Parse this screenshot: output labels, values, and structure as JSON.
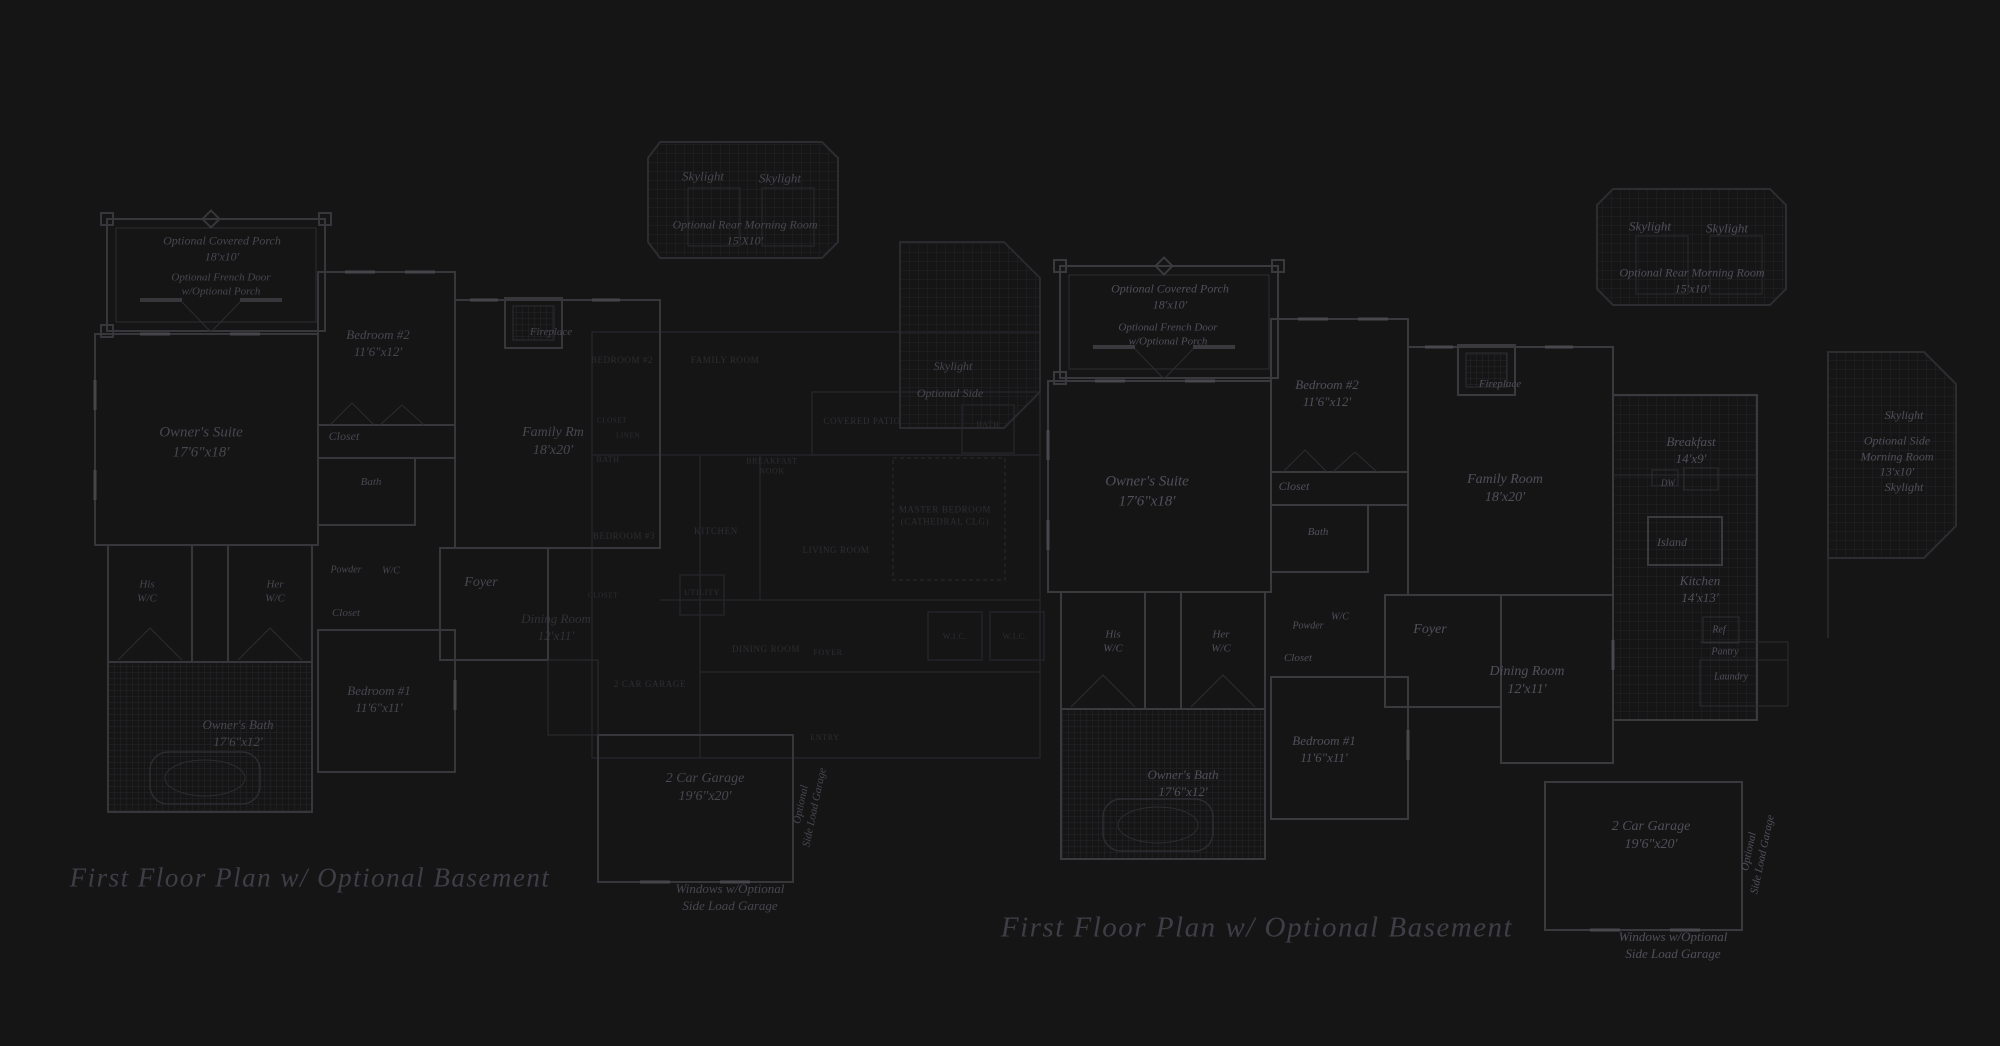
{
  "page": {
    "background": "#151516",
    "wall_color_bright": "#3a3a3e",
    "wall_color_mid": "#2d2d31",
    "wall_color_faint": "#242428",
    "grid_color": "#222226",
    "label_color": "#4b4b52",
    "caption_color": "#3e3e46"
  },
  "captions": {
    "left": "First Floor Plan  w/ Optional Basement",
    "right": "First Floor Plan  w/ Optional Basement"
  },
  "plans": {
    "left_plan": {
      "title": "First Floor Plan w/ Optional Basement (left)",
      "labels": [
        {
          "t": "Optional Covered Porch\n18'x10'",
          "x": 222,
          "y": 249,
          "s": 12
        },
        {
          "t": "Optional French Door\nw/Optional Porch",
          "x": 221,
          "y": 285,
          "s": 11
        },
        {
          "t": "Owner's Suite\n17'6\"x18'",
          "x": 201,
          "y": 443,
          "s": 15
        },
        {
          "t": "Bedroom #2\n11'6\"x12'",
          "x": 378,
          "y": 344,
          "s": 13
        },
        {
          "t": "Closet",
          "x": 344,
          "y": 437,
          "s": 12
        },
        {
          "t": "Bath",
          "x": 371,
          "y": 482,
          "s": 11
        },
        {
          "t": "Fireplace",
          "x": 551,
          "y": 332,
          "s": 11
        },
        {
          "t": "Family Rm\n18'x20'",
          "x": 553,
          "y": 442,
          "s": 14
        },
        {
          "t": "His\nW/C",
          "x": 147,
          "y": 592,
          "s": 11
        },
        {
          "t": "Her\nW/C",
          "x": 275,
          "y": 592,
          "s": 11
        },
        {
          "t": "Powder",
          "x": 346,
          "y": 570,
          "s": 10
        },
        {
          "t": "W/C",
          "x": 391,
          "y": 571,
          "s": 10
        },
        {
          "t": "Closet",
          "x": 346,
          "y": 613,
          "s": 11
        },
        {
          "t": "Foyer",
          "x": 481,
          "y": 583,
          "s": 14
        },
        {
          "t": "Dining Room\n12'x11'",
          "x": 556,
          "y": 628,
          "s": 13,
          "o": 0.55
        },
        {
          "t": "Bedroom #1\n11'6\"x11'",
          "x": 379,
          "y": 700,
          "s": 13
        },
        {
          "t": "Owner's Bath\n17'6\"x12'",
          "x": 238,
          "y": 734,
          "s": 13
        },
        {
          "t": "2 Car Garage\n19'6\"x20'",
          "x": 705,
          "y": 788,
          "s": 14
        },
        {
          "t": "Optional\nSide Load Garage",
          "x": 808,
          "y": 806,
          "s": 11,
          "r": -78
        },
        {
          "t": "Windows w/Optional\nSide Load Garage",
          "x": 730,
          "y": 898,
          "s": 13
        },
        {
          "t": "Skylight",
          "x": 703,
          "y": 177,
          "s": 13
        },
        {
          "t": "Skylight",
          "x": 780,
          "y": 179,
          "s": 13
        },
        {
          "t": "Optional Rear Morning Room\n15'X10'",
          "x": 745,
          "y": 233,
          "s": 12
        },
        {
          "t": "Skylight",
          "x": 953,
          "y": 367,
          "s": 12
        },
        {
          "t": "Optional Side",
          "x": 950,
          "y": 394,
          "s": 12
        }
      ]
    },
    "faint_overlay_plan": {
      "title": "underlying alternate plan (very faint)",
      "labels": [
        {
          "t": "BEDROOM #2",
          "x": 622,
          "y": 361,
          "s": 9
        },
        {
          "t": "FAMILY ROOM",
          "x": 725,
          "y": 361,
          "s": 9
        },
        {
          "t": "CLOSET",
          "x": 612,
          "y": 421,
          "s": 7
        },
        {
          "t": "LINEN",
          "x": 628,
          "y": 436,
          "s": 7
        },
        {
          "t": "BATH",
          "x": 608,
          "y": 460,
          "s": 8
        },
        {
          "t": "BREAKFAST\nNOOK",
          "x": 772,
          "y": 467,
          "s": 8
        },
        {
          "t": "BEDROOM #3",
          "x": 624,
          "y": 537,
          "s": 9
        },
        {
          "t": "KITCHEN",
          "x": 716,
          "y": 532,
          "s": 9
        },
        {
          "t": "UTILITY",
          "x": 702,
          "y": 593,
          "s": 8
        },
        {
          "t": "CLOSET",
          "x": 603,
          "y": 596,
          "s": 7
        },
        {
          "t": "DINING ROOM",
          "x": 766,
          "y": 650,
          "s": 9
        },
        {
          "t": "FOYER",
          "x": 828,
          "y": 653,
          "s": 8
        },
        {
          "t": "2 CAR GARAGE",
          "x": 650,
          "y": 685,
          "s": 9
        },
        {
          "t": "ENTRY",
          "x": 825,
          "y": 738,
          "s": 8
        },
        {
          "t": "COVERED PATIO",
          "x": 862,
          "y": 422,
          "s": 9
        },
        {
          "t": "MASTER BEDROOM\n(CATHEDRAL CLG)",
          "x": 945,
          "y": 516,
          "s": 9
        },
        {
          "t": "LIVING ROOM",
          "x": 836,
          "y": 551,
          "s": 9
        },
        {
          "t": "BATH",
          "x": 988,
          "y": 425,
          "s": 8
        },
        {
          "t": "W.I.C.",
          "x": 955,
          "y": 637,
          "s": 8
        },
        {
          "t": "W.I.C.",
          "x": 1015,
          "y": 637,
          "s": 8
        }
      ]
    },
    "right_plan": {
      "title": "First Floor Plan w/ Optional Basement (right)",
      "labels": [
        {
          "t": "Optional Covered Porch\n18'x10'",
          "x": 1170,
          "y": 297,
          "s": 12
        },
        {
          "t": "Optional French Door\nw/Optional Porch",
          "x": 1168,
          "y": 335,
          "s": 11
        },
        {
          "t": "Owner's Suite\n17'6\"x18'",
          "x": 1147,
          "y": 492,
          "s": 15
        },
        {
          "t": "Bedroom #2\n11'6\"x12'",
          "x": 1327,
          "y": 394,
          "s": 13
        },
        {
          "t": "Closet",
          "x": 1294,
          "y": 487,
          "s": 12
        },
        {
          "t": "Bath",
          "x": 1318,
          "y": 532,
          "s": 11
        },
        {
          "t": "Fireplace",
          "x": 1500,
          "y": 384,
          "s": 11
        },
        {
          "t": "Family Room\n18'x20'",
          "x": 1505,
          "y": 489,
          "s": 14
        },
        {
          "t": "Breakfast\n14'x9'",
          "x": 1691,
          "y": 451,
          "s": 13
        },
        {
          "t": "DW",
          "x": 1668,
          "y": 484,
          "s": 9
        },
        {
          "t": "Island",
          "x": 1672,
          "y": 543,
          "s": 12
        },
        {
          "t": "Kitchen\n14'x13'",
          "x": 1700,
          "y": 590,
          "s": 13
        },
        {
          "t": "Ref",
          "x": 1719,
          "y": 630,
          "s": 10
        },
        {
          "t": "Pantry",
          "x": 1725,
          "y": 652,
          "s": 10
        },
        {
          "t": "Laundry",
          "x": 1731,
          "y": 677,
          "s": 10
        },
        {
          "t": "Dining Room\n12'x11'",
          "x": 1527,
          "y": 681,
          "s": 14
        },
        {
          "t": "His\nW/C",
          "x": 1113,
          "y": 642,
          "s": 11
        },
        {
          "t": "Her\nW/C",
          "x": 1221,
          "y": 642,
          "s": 11
        },
        {
          "t": "Powder",
          "x": 1308,
          "y": 626,
          "s": 10
        },
        {
          "t": "W/C",
          "x": 1340,
          "y": 617,
          "s": 10
        },
        {
          "t": "Closet",
          "x": 1298,
          "y": 658,
          "s": 11
        },
        {
          "t": "Foyer",
          "x": 1430,
          "y": 630,
          "s": 14
        },
        {
          "t": "Bedroom #1\n11'6\"x11'",
          "x": 1324,
          "y": 750,
          "s": 13
        },
        {
          "t": "Owner's Bath\n17'6\"x12'",
          "x": 1183,
          "y": 784,
          "s": 13
        },
        {
          "t": "2 Car Garage\n19'6\"x20'",
          "x": 1651,
          "y": 836,
          "s": 14
        },
        {
          "t": "Optional\nSide Load Garage",
          "x": 1756,
          "y": 853,
          "s": 11,
          "r": -78
        },
        {
          "t": "Windows w/Optional\nSide Load Garage",
          "x": 1673,
          "y": 946,
          "s": 13
        },
        {
          "t": "Skylight",
          "x": 1650,
          "y": 227,
          "s": 13
        },
        {
          "t": "Skylight",
          "x": 1727,
          "y": 229,
          "s": 13
        },
        {
          "t": "Optional Rear Morning Room\n15'x10'",
          "x": 1692,
          "y": 281,
          "s": 12
        },
        {
          "t": "Skylight",
          "x": 1904,
          "y": 416,
          "s": 12
        },
        {
          "t": "Optional Side\nMorning Room\n13'x10'",
          "x": 1897,
          "y": 457,
          "s": 12
        },
        {
          "t": "Skylight",
          "x": 1904,
          "y": 488,
          "s": 12
        }
      ]
    }
  }
}
